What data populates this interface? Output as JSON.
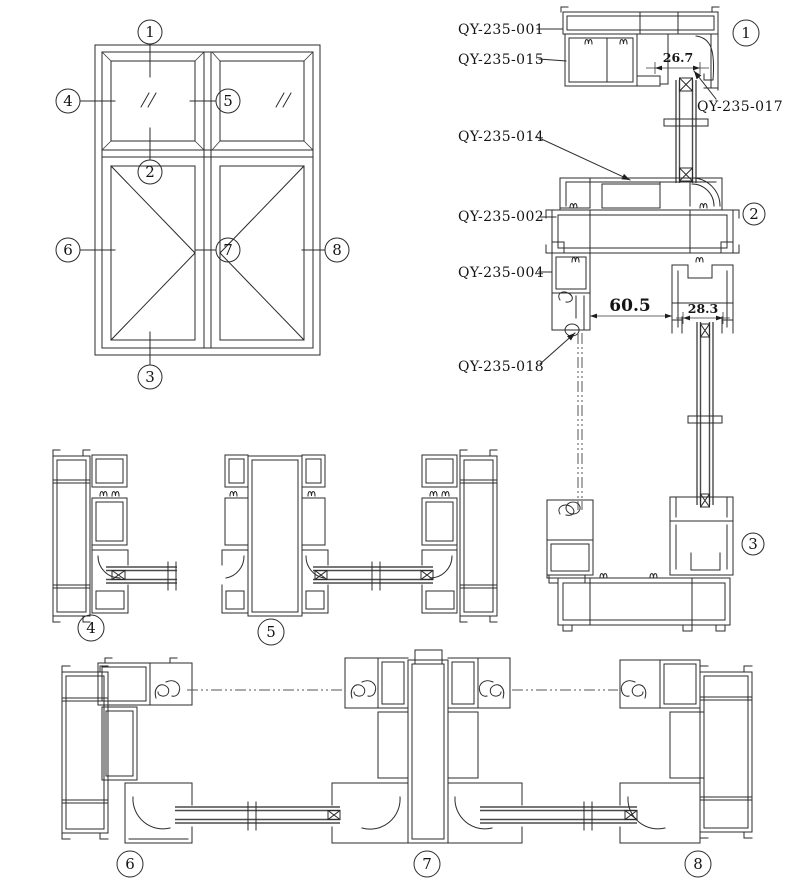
{
  "colors": {
    "line": "#2b2b2b",
    "background": "#ffffff",
    "glass_line": "#4a4a4a"
  },
  "part_labels": {
    "p001": "QY-235-001",
    "p015": "QY-235-015",
    "p017": "QY-235-017",
    "p014": "QY-235-014",
    "p002": "QY-235-002",
    "p004": "QY-235-004",
    "p018": "QY-235-018"
  },
  "dimensions": {
    "d26": "26.7",
    "d60": "60.5",
    "d28": "28.3"
  },
  "markers": {
    "m1": "1",
    "m2": "2",
    "m3": "3",
    "m4": "4",
    "m5": "5",
    "m6": "6",
    "m7": "7",
    "m8": "8"
  }
}
